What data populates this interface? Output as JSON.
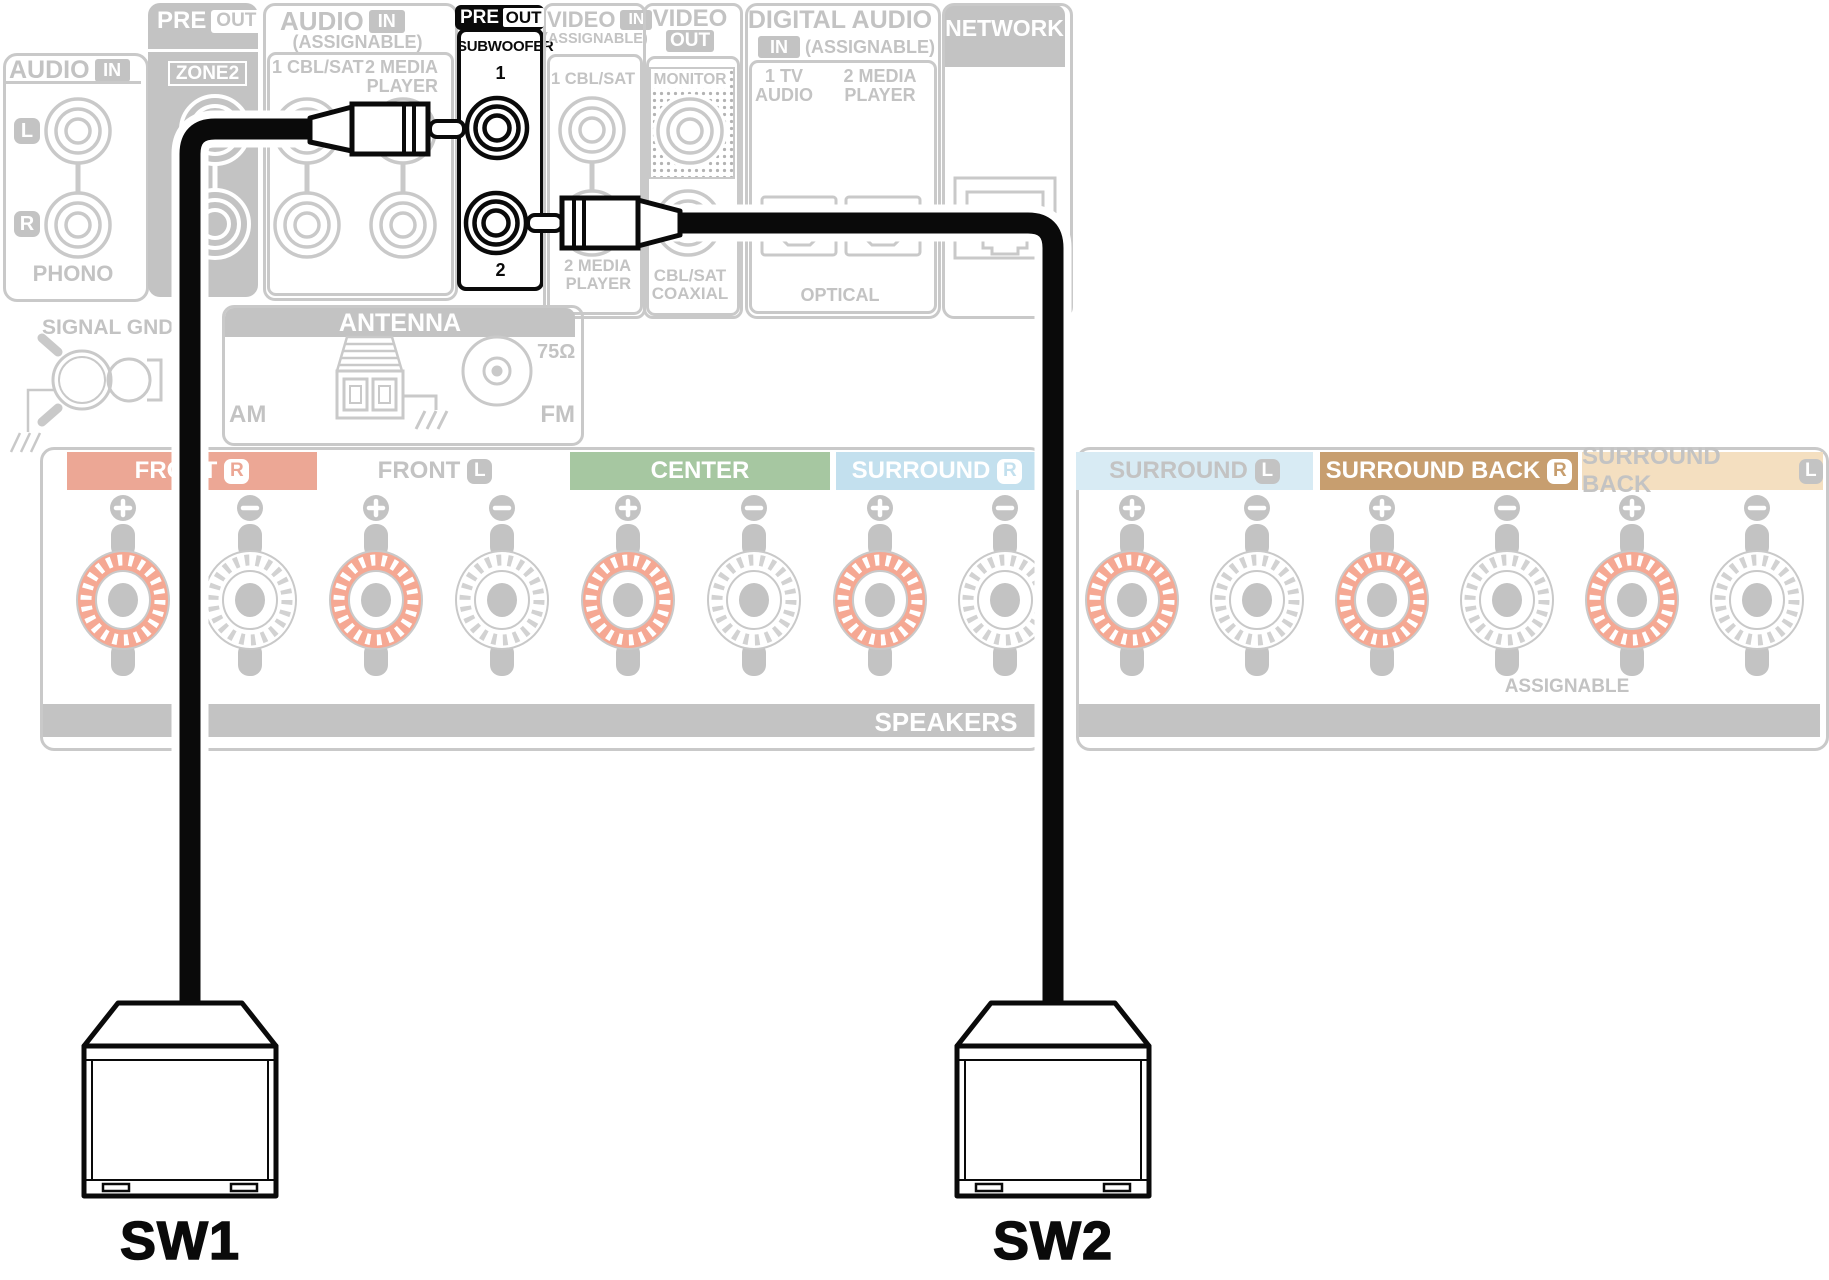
{
  "title": "AV receiver rear panel — dual subwoofer pre-out connection",
  "colors": {
    "inactive_gray_line": "#c9c9c9",
    "inactive_gray_fill": "#c3c3c3",
    "highlight_black": "#0a0a0a",
    "front_r_tag": "#ECA795",
    "center_tag": "#A6C7A1",
    "surround_r_tag": "#C3E0EE",
    "surround_l_tag": "#D8EBF4",
    "surround_back_r_tag": "#C79E6F",
    "surround_back_l_tag": "#F4DFC0",
    "positive_post": "#F5A893"
  },
  "panel": {
    "phono": {
      "header": "AUDIO",
      "badge": "IN",
      "left": "L",
      "right": "R",
      "label": "PHONO"
    },
    "signal_gnd": "SIGNAL GND",
    "zone2": {
      "header": "PRE",
      "badge": "OUT",
      "label": "ZONE2"
    },
    "audio_in": {
      "header": "AUDIO",
      "badge": "IN",
      "sub": "(ASSIGNABLE)",
      "col1": "1 CBL/SAT",
      "col2a": "2 MEDIA",
      "col2b": "PLAYER"
    },
    "pre_out_sw": {
      "header": "PRE",
      "badge": "OUT",
      "label": "SUBWOOFER",
      "jack1": "1",
      "jack2": "2"
    },
    "video_in": {
      "header": "VIDEO",
      "badge": "IN",
      "sub": "(ASSIGNABLE)",
      "col1": "1 CBL/SAT",
      "col2a": "2 MEDIA",
      "col2b": "PLAYER"
    },
    "video_out": {
      "header": "VIDEO",
      "badge": "OUT",
      "monitor": "MONITOR",
      "coax1": "CBL/SAT",
      "coax2": "COAXIAL"
    },
    "digital_audio": {
      "header": "DIGITAL AUDIO",
      "badge": "IN",
      "sub": "(ASSIGNABLE)",
      "col1a": "1 TV",
      "col1b": "AUDIO",
      "col2a": "2 MEDIA",
      "col2b": "PLAYER",
      "optical": "OPTICAL"
    },
    "network": {
      "header": "NETWORK"
    },
    "antenna": {
      "header": "ANTENNA",
      "am": "AM",
      "fm": "FM",
      "ohm": "75Ω"
    },
    "speakers": {
      "tags": [
        {
          "label": "FRONT",
          "badge": "R"
        },
        {
          "label": "FRONT",
          "badge": "L"
        },
        {
          "label": "CENTER",
          "badge": ""
        },
        {
          "label": "SURROUND",
          "badge": "R"
        },
        {
          "label": "SURROUND",
          "badge": "L"
        },
        {
          "label": "SURROUND BACK",
          "badge": "R"
        },
        {
          "label": "SURROUND BACK",
          "badge": "L"
        }
      ],
      "assignable": "ASSIGNABLE",
      "bar": "SPEAKERS"
    }
  },
  "subwoofers": [
    {
      "label": "SW1"
    },
    {
      "label": "SW2"
    }
  ]
}
